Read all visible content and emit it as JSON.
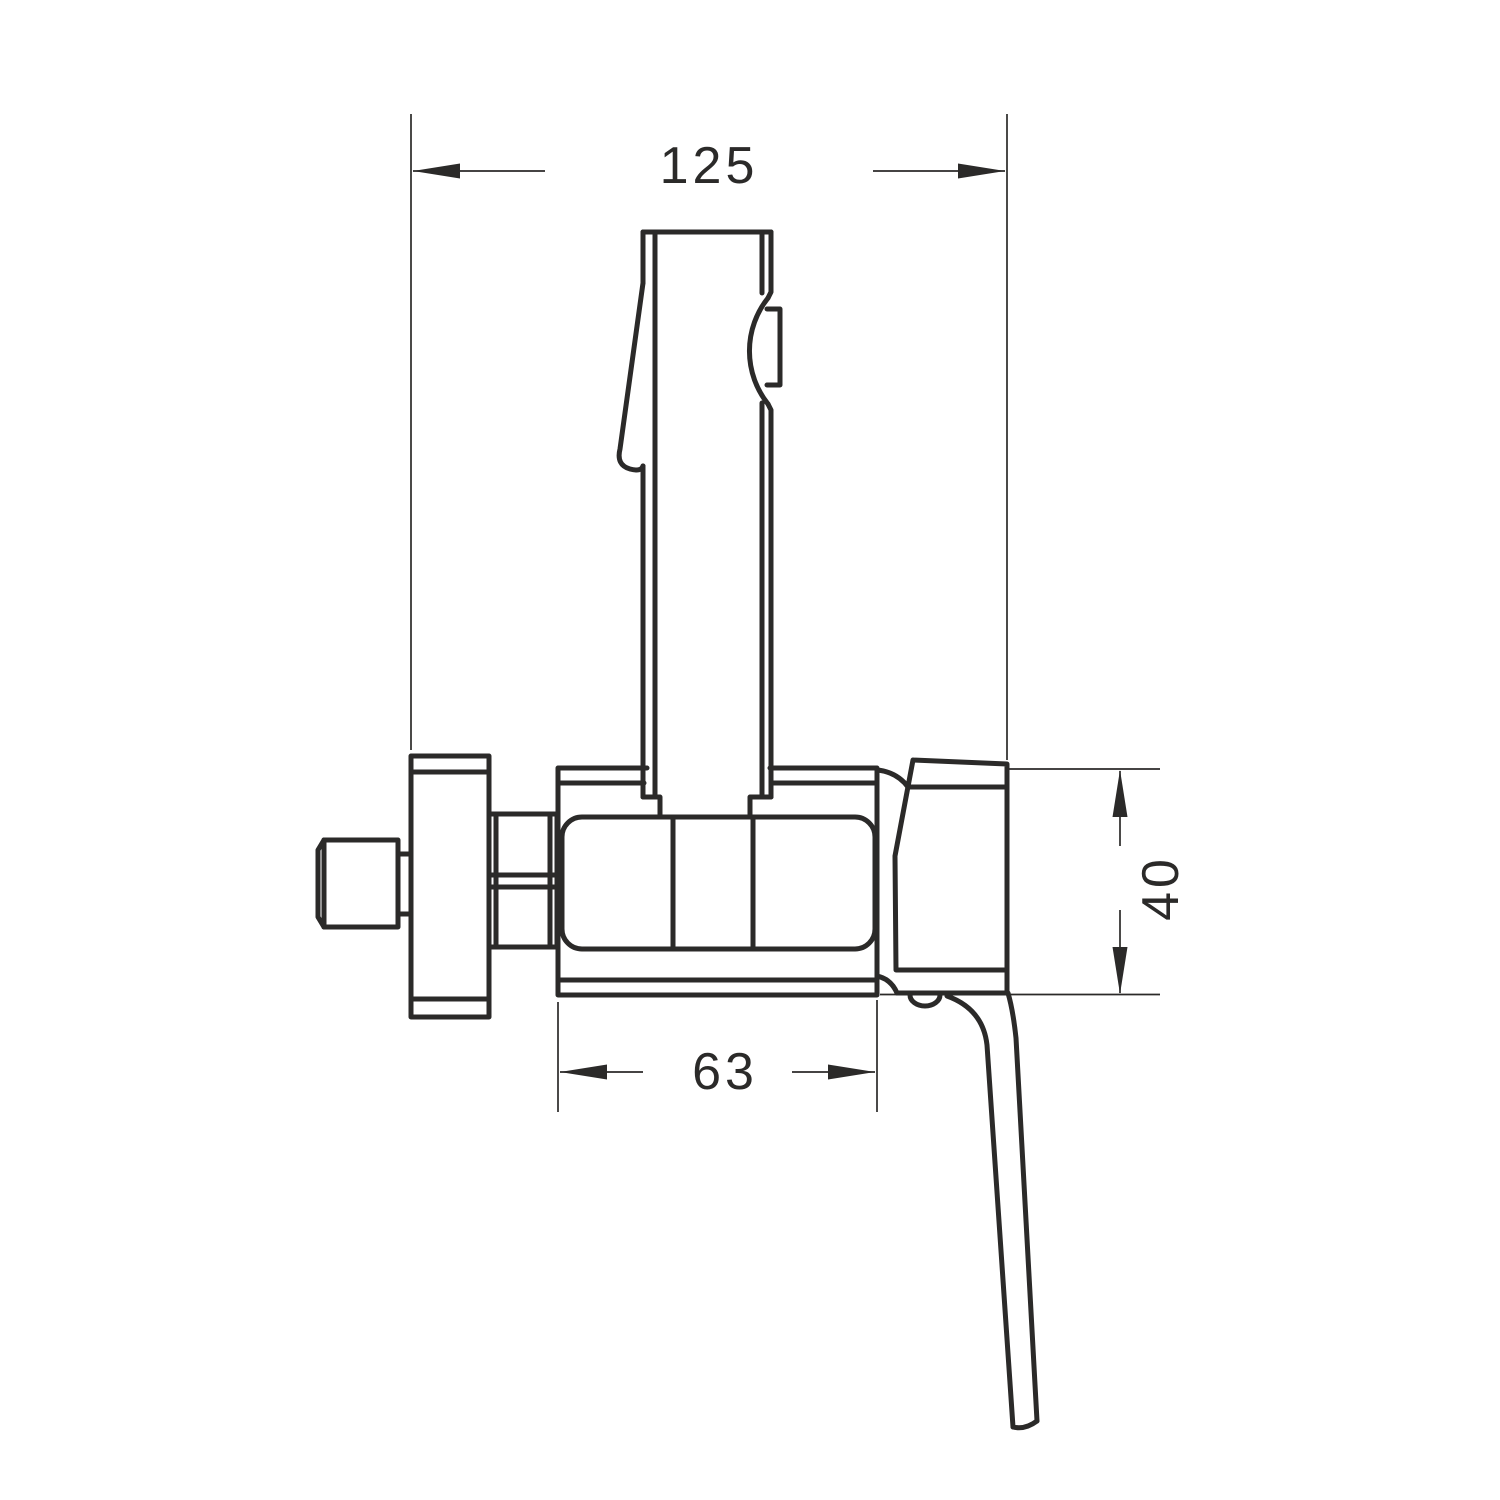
{
  "drawing": {
    "background": "#ffffff",
    "line_color": "#2b2a29",
    "dimensions": {
      "overall_width": {
        "value": "125"
      },
      "body_width": {
        "value": "63"
      },
      "body_height": {
        "value": "40"
      }
    }
  }
}
